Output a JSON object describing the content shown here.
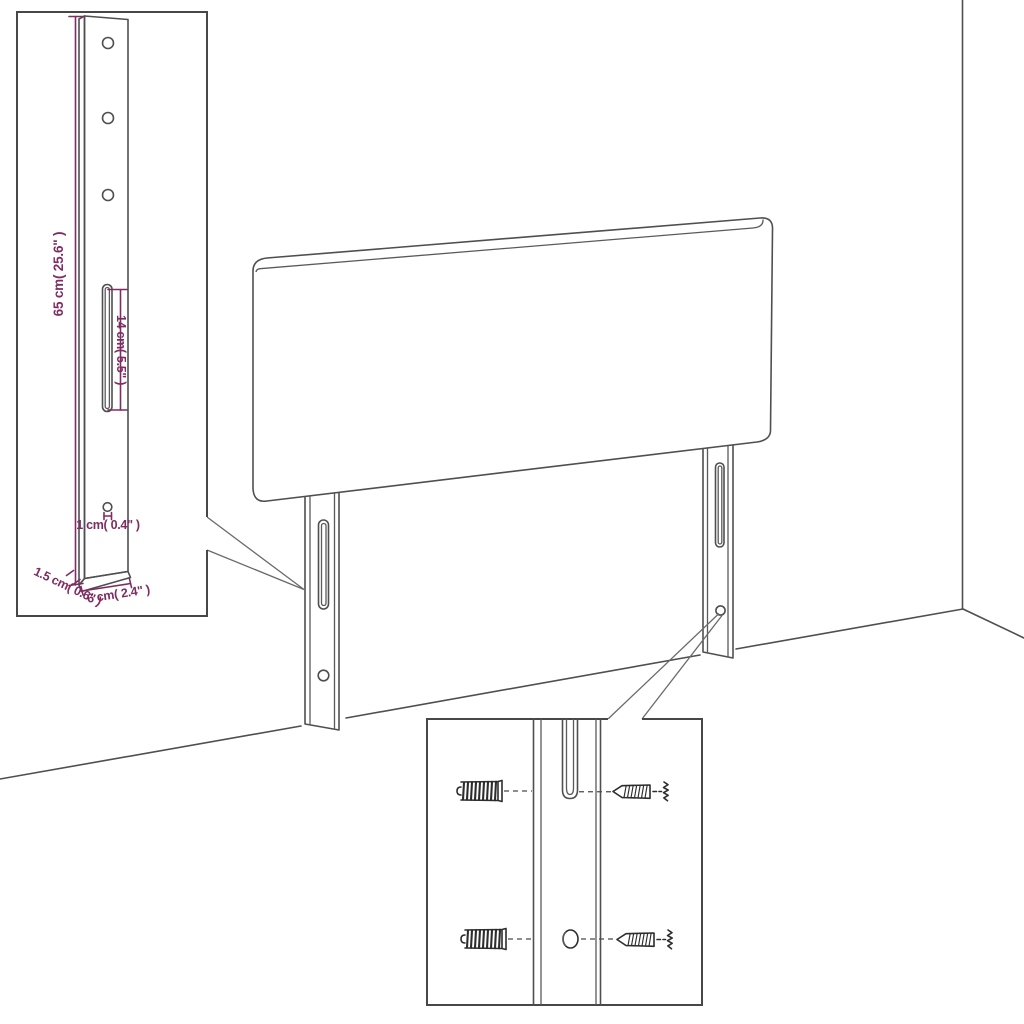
{
  "diagram": {
    "kind": "headboard-assembly-dimension-diagram",
    "background": "#ffffff",
    "colors": {
      "line_art": "#4f4f4f",
      "dimension_annotation": "#7e2d62",
      "hardware_ink": "#2d2d2d"
    }
  },
  "labels": {
    "leg_height": "65 cm( 25.6\" )",
    "slot_length": "14 cm( 5.5\" )",
    "hole_diameter": "1 cm( 0.4\" )",
    "leg_thickness": "1.5 cm( 0.6\" )",
    "leg_width": "6 cm( 2.4\" )"
  }
}
